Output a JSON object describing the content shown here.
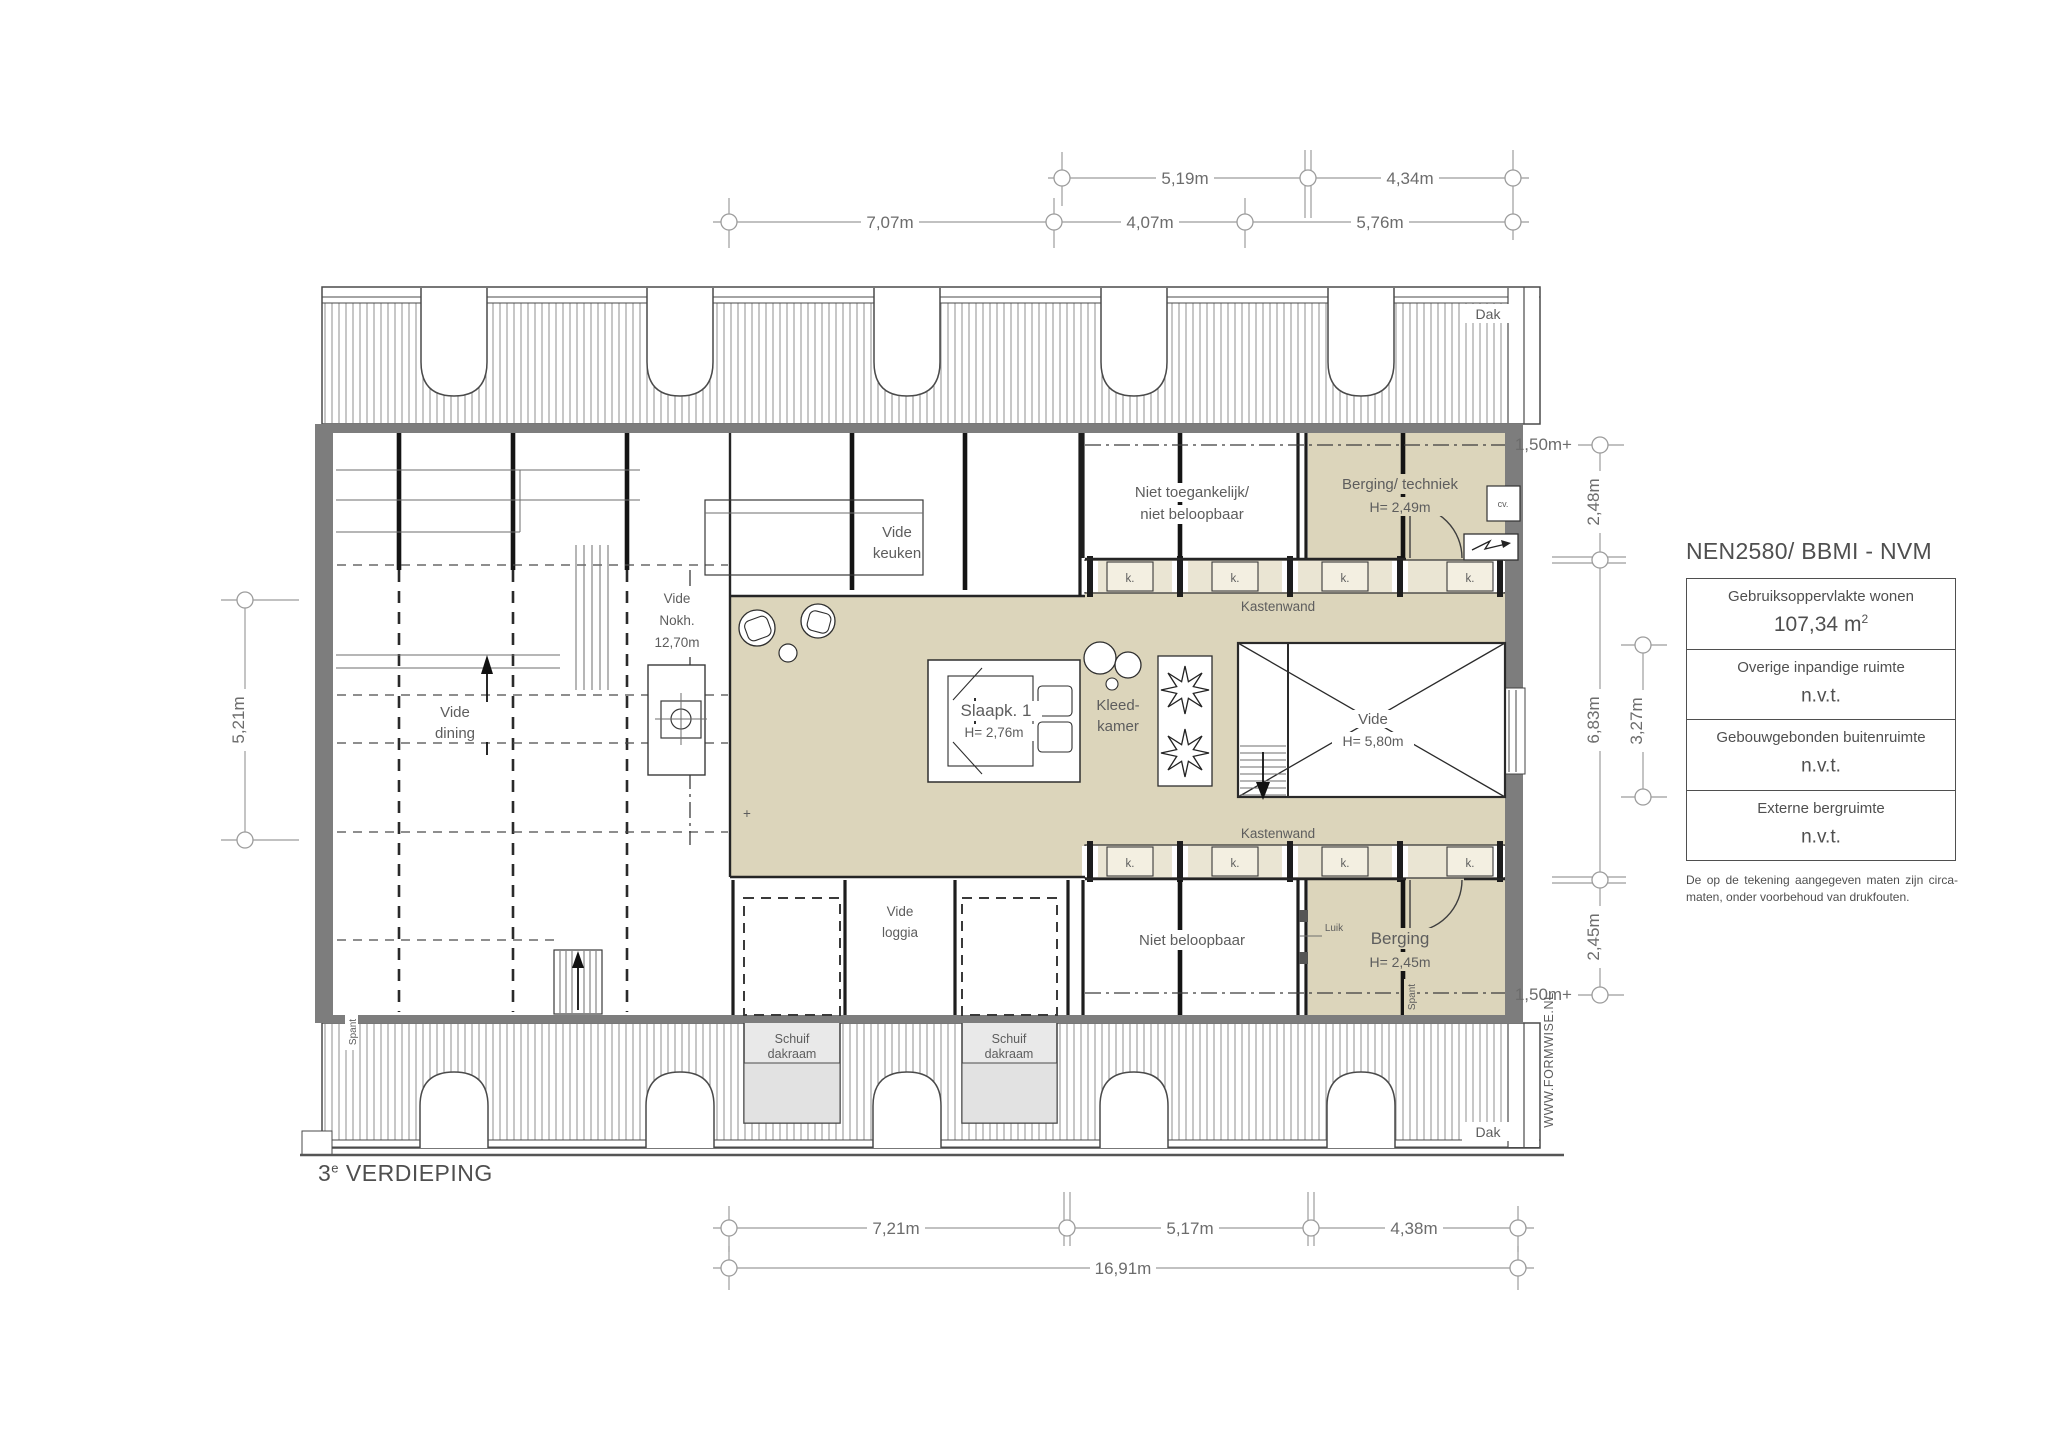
{
  "floor_plan": {
    "title": {
      "number": "3",
      "sup": "e",
      "name": "VERDIEPING"
    },
    "watermark": "WWW.FORMWISE.NL",
    "colors": {
      "room_fill": "#dcd5bb",
      "cabinet_strip": "#eae5d3",
      "cabinet_box": "#f3efe1",
      "wall": "#7d7d7d",
      "skylight": "#e9e9e9",
      "dim_line": "#9c9c9c"
    },
    "rooms": {
      "vide_dining": {
        "line1": "Vide",
        "line2": "dining"
      },
      "vide_keuken": {
        "line1": "Vide",
        "line2": "keuken"
      },
      "vide_nok": {
        "line1": "Vide",
        "line2": "Nokh.",
        "line3": "12,70m"
      },
      "vide_loggia": {
        "line1": "Vide",
        "line2": "loggia"
      },
      "slaapk1": {
        "name": "Slaapk. 1",
        "height": "H= 2,76m"
      },
      "kleedkamer": {
        "line1": "Kleed-",
        "line2": "kamer"
      },
      "vide_center": {
        "name": "Vide",
        "height": "H= 5,80m"
      },
      "niet_toegankelijk": {
        "line1": "Niet toegankelijk/",
        "line2": "niet beloopbaar"
      },
      "berging_techniek": {
        "name": "Berging/ techniek",
        "height": "H= 2,49m"
      },
      "berging": {
        "name": "Berging",
        "height": "H= 2,45m"
      },
      "niet_beloopbaar": {
        "name": "Niet beloopbaar"
      },
      "kastenwand": "Kastenwand",
      "schuif_dakraam": {
        "line1": "Schuif",
        "line2": "dakraam"
      }
    },
    "features": {
      "k": "k.",
      "luik": "Luik",
      "cv": "cv.",
      "dak": "Dak",
      "spant": "Spant",
      "plus": "+"
    },
    "dimensions": {
      "top_row_inner": [
        "5,19m",
        "4,34m"
      ],
      "top_row_outer": [
        "7,07m",
        "4,07m",
        "5,76m"
      ],
      "bottom_row": [
        "7,21m",
        "5,17m",
        "4,38m"
      ],
      "bottom_total": "16,91m",
      "left": "5,21m",
      "right_top_level": "1,50m+",
      "right_bottom_level": "1,50m+",
      "right_column": [
        "2,48m",
        "6,83m",
        "2,45m"
      ],
      "right_inner": "3,27m"
    }
  },
  "info_panel": {
    "heading": "NEN2580/ BBMI - NVM",
    "rows": [
      {
        "label": "Gebruiksoppervlakte wonen",
        "value": "107,34 m",
        "value_sup": "2"
      },
      {
        "label": "Overige inpandige ruimte",
        "value": "n.v.t.",
        "value_sup": ""
      },
      {
        "label": "Gebouwgebonden buitenruimte",
        "value": "n.v.t.",
        "value_sup": ""
      },
      {
        "label": "Externe bergruimte",
        "value": "n.v.t.",
        "value_sup": ""
      }
    ],
    "disclaimer": "De op de tekening aangegeven maten zijn circa-maten, onder voorbehoud van drukfouten."
  }
}
